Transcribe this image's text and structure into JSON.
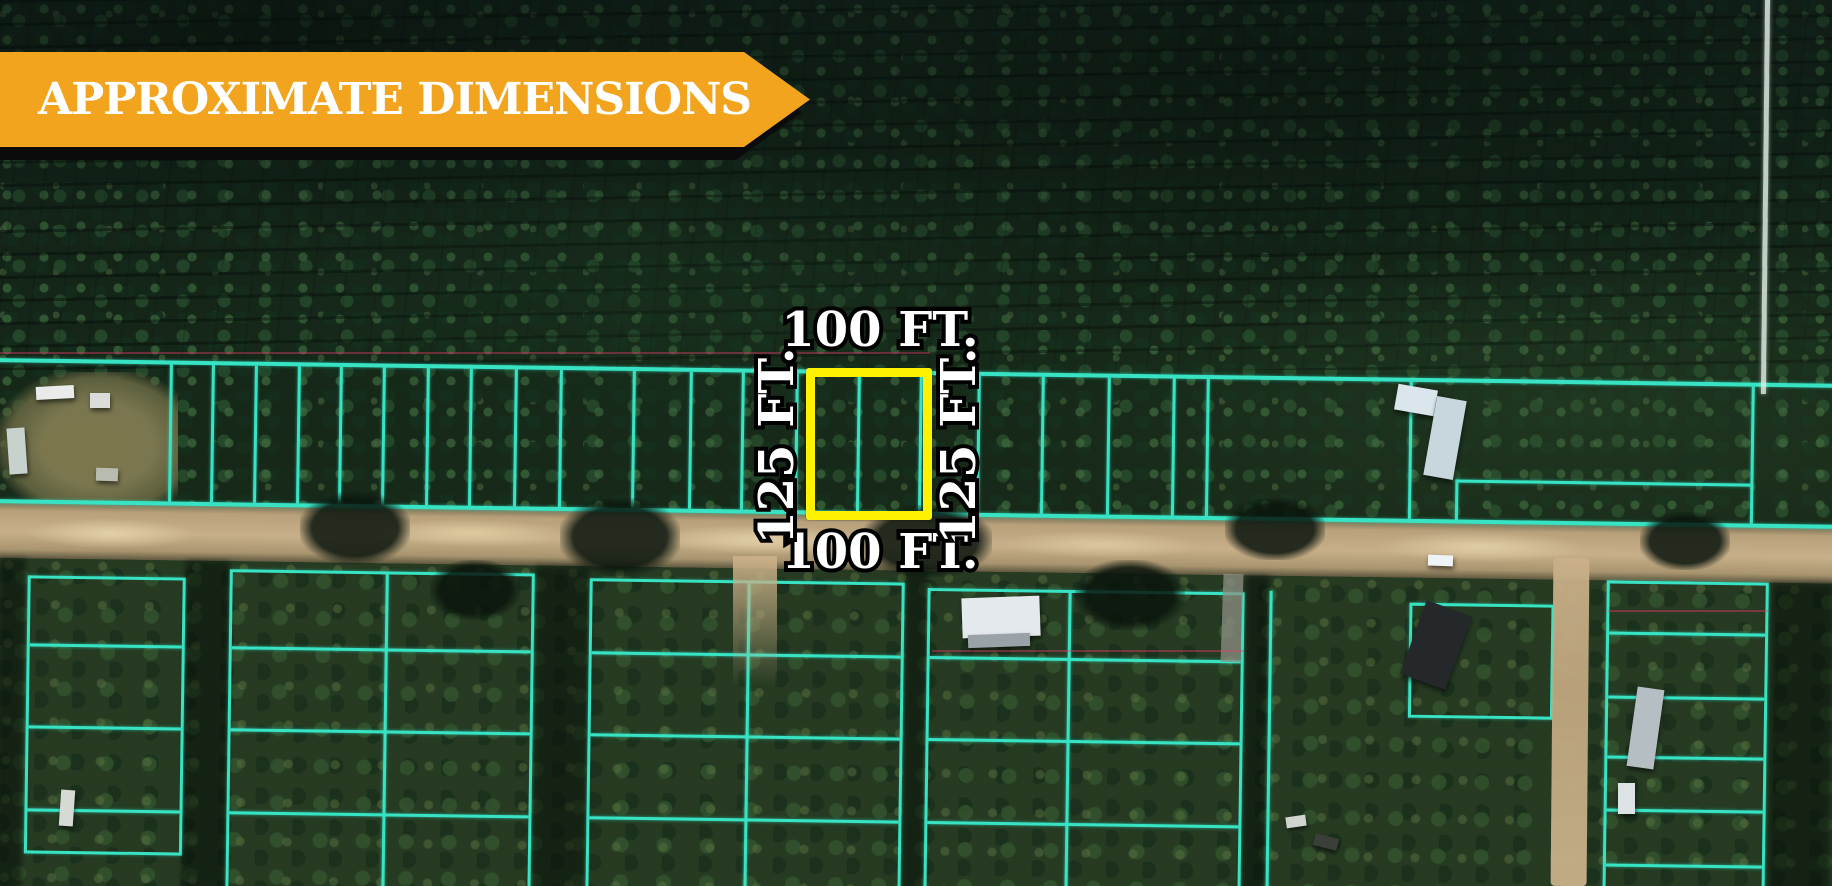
{
  "banner": {
    "label": "APPROXIMATE DIMENSIONS",
    "background_color": "#F2A41E",
    "shadow_color": "#0B0B0B",
    "text_color": "#FFFFFF"
  },
  "parcel_annotation": {
    "top_dimension": "100 FT.",
    "bottom_dimension": "100 FT.",
    "left_dimension": "125 FT.",
    "right_dimension": "125 FT.",
    "outline_color": "#FFF200"
  },
  "map_overlay": {
    "lot_line_color": "#38E3C4"
  }
}
